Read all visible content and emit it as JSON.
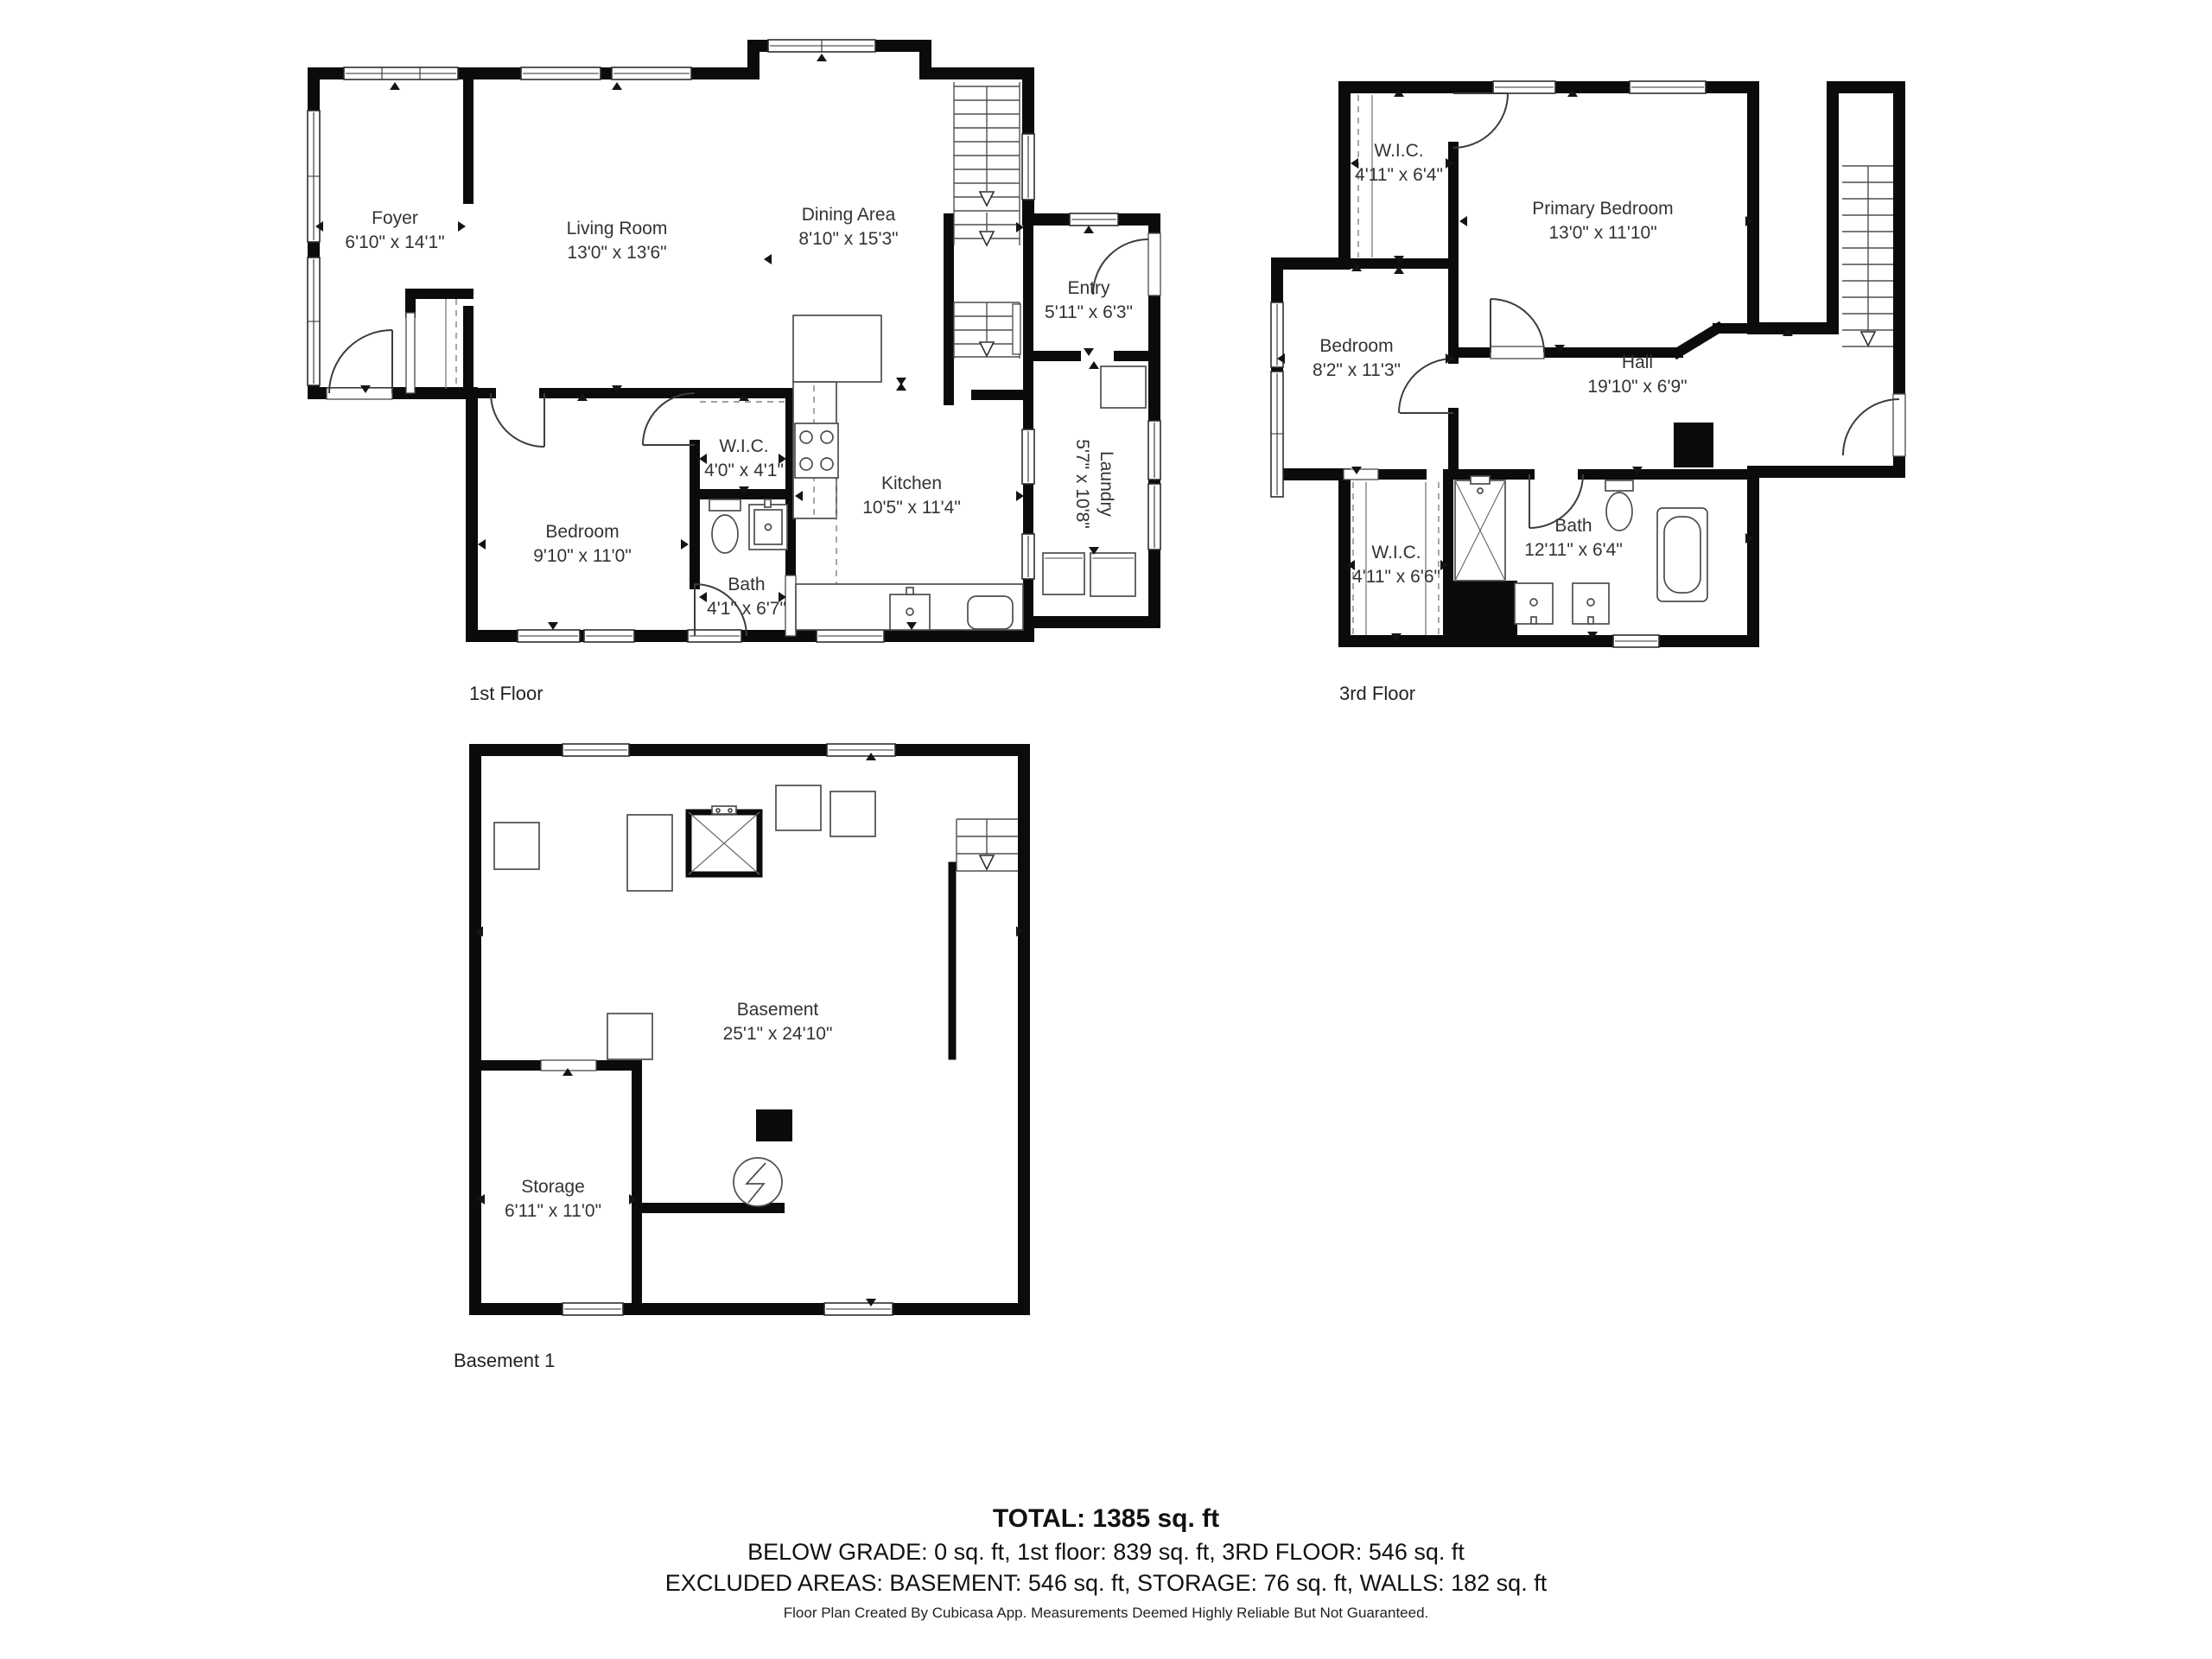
{
  "plans": [
    {
      "label": "1st Floor",
      "rooms": [
        {
          "name": "Foyer",
          "dims": "6'10\" x 14'1\""
        },
        {
          "name": "Living Room",
          "dims": "13'0\" x 13'6\""
        },
        {
          "name": "Dining Area",
          "dims": "8'10\" x 15'3\""
        },
        {
          "name": "Entry",
          "dims": "5'11\" x 6'3\""
        },
        {
          "name": "Laundry",
          "dims": "5'7\" x 10'8\""
        },
        {
          "name": "Bedroom",
          "dims": "9'10\" x 11'0\""
        },
        {
          "name": "W.I.C.",
          "dims": "4'0\" x 4'1\""
        },
        {
          "name": "Bath",
          "dims": "4'1\" x 6'7\""
        },
        {
          "name": "Kitchen",
          "dims": "10'5\" x 11'4\""
        }
      ]
    },
    {
      "label": "3rd Floor",
      "rooms": [
        {
          "name": "W.I.C.",
          "dims": "4'11\" x 6'4\""
        },
        {
          "name": "Primary Bedroom",
          "dims": "13'0\" x 11'10\""
        },
        {
          "name": "Bedroom",
          "dims": "8'2\" x 11'3\""
        },
        {
          "name": "Hall",
          "dims": "19'10\" x 6'9\""
        },
        {
          "name": "W.I.C.",
          "dims": "4'11\" x 6'6\""
        },
        {
          "name": "Bath",
          "dims": "12'11\" x 6'4\""
        }
      ]
    },
    {
      "label": "Basement 1",
      "rooms": [
        {
          "name": "Basement",
          "dims": "25'1\" x 24'10\""
        },
        {
          "name": "Storage",
          "dims": "6'11\" x 11'0\""
        }
      ]
    }
  ],
  "summary": {
    "total": "TOTAL: 1385 sq. ft",
    "line2": "BELOW GRADE: 0 sq. ft, 1st floor: 839 sq. ft, 3RD FLOOR: 546 sq. ft",
    "line3": "EXCLUDED AREAS: BASEMENT: 546 sq. ft, STORAGE: 76 sq. ft, WALLS: 182 sq. ft"
  },
  "footer": "Floor Plan Created By Cubicasa App. Measurements Deemed Highly Reliable But Not Guaranteed."
}
